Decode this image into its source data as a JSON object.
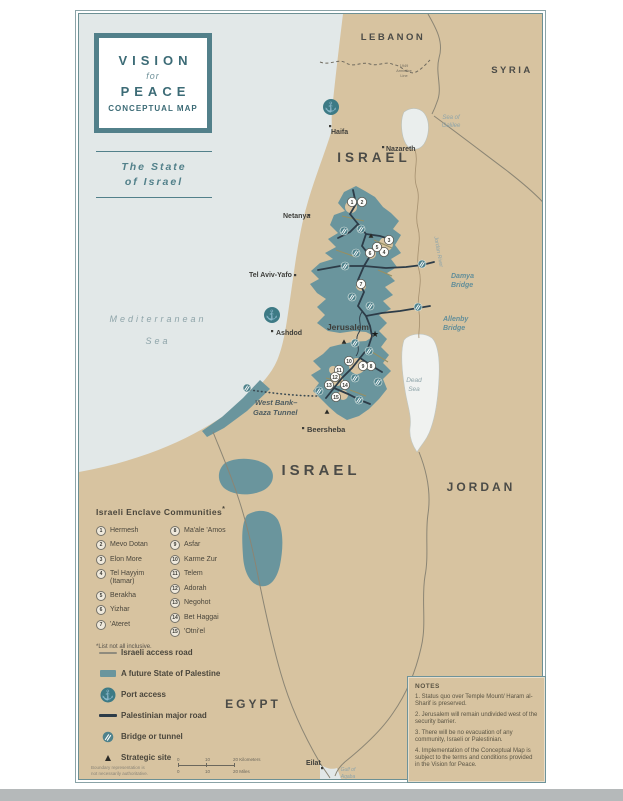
{
  "title_card": {
    "line1": "VISION",
    "line2": "for",
    "line3": "PEACE",
    "line4": "CONCEPTUAL MAP"
  },
  "subtitle": {
    "line1": "The State",
    "line2": "of Israel"
  },
  "countries": {
    "lebanon": "LEBANON",
    "syria": "SYRIA",
    "israel_north": "ISRAEL",
    "israel_south": "ISRAEL",
    "jordan": "JORDAN",
    "egypt": "EGYPT"
  },
  "cities": {
    "haifa": "Haifa",
    "nazareth": "Nazareth",
    "netanya": "Netanya",
    "tel_aviv": "Tel Aviv-Yafo",
    "ashdod": "Ashdod",
    "jerusalem": "Jerusalem",
    "beersheba": "Beersheba",
    "eilat": "Eilat"
  },
  "water": {
    "mediterranean_1": "Mediterranean",
    "mediterranean_2": "Sea",
    "galilee_1": "Sea of",
    "galilee_2": "Galilee",
    "dead_sea_1": "Dead",
    "dead_sea_2": "Sea",
    "aqaba_1": "Gulf of",
    "aqaba_2": "Aqaba",
    "jordan_river": "Jordan River"
  },
  "bridge_labels": {
    "damya_1": "Damya",
    "damya_2": "Bridge",
    "allenby_1": "Allenby",
    "allenby_2": "Bridge"
  },
  "armistice": {
    "line1": "1949",
    "line2": "Armistice",
    "line3": "Line"
  },
  "tunnel_label": {
    "line1": "West Bank–",
    "line2": "Gaza Tunnel"
  },
  "enclaves": {
    "title": "Israeli Enclave Communities",
    "footnote_mark": "*",
    "footnote": "*List not all inclusive.",
    "items": [
      {
        "num": "1",
        "name": "Hermesh"
      },
      {
        "num": "2",
        "name": "Mevo Dotan"
      },
      {
        "num": "3",
        "name": "Elon More"
      },
      {
        "num": "4",
        "name": "Tel Hayyim (Itamar)"
      },
      {
        "num": "5",
        "name": "Berakha"
      },
      {
        "num": "6",
        "name": "Yizhar"
      },
      {
        "num": "7",
        "name": "'Ateret"
      },
      {
        "num": "8",
        "name": "Ma'ale 'Amos"
      },
      {
        "num": "9",
        "name": "Asfar"
      },
      {
        "num": "10",
        "name": "Karme Zur"
      },
      {
        "num": "11",
        "name": "Telem"
      },
      {
        "num": "12",
        "name": "Adorah"
      },
      {
        "num": "13",
        "name": "Negohot"
      },
      {
        "num": "14",
        "name": "Bet Haggai"
      },
      {
        "num": "15",
        "name": "'Otni'el"
      }
    ]
  },
  "legend": {
    "items": [
      {
        "icon": "israeli-access-road",
        "label": "Israeli access road"
      },
      {
        "icon": "palestine-area",
        "label": "A future State of Palestine"
      },
      {
        "icon": "port",
        "label": "Port access"
      },
      {
        "icon": "palestinian-road",
        "label": "Palestinian major road"
      },
      {
        "icon": "bridge",
        "label": "Bridge or tunnel"
      },
      {
        "icon": "strategic",
        "label": "Strategic site"
      }
    ]
  },
  "notes": {
    "title": "NOTES",
    "items": [
      "1. Status quo over Temple Mount/ Haram al-Sharif is preserved.",
      "2. Jerusalem will remain undivided west of the security barrier.",
      "3. There will be no evacuation of any community, Israeli or Palestinian.",
      "4. Implementation of the Conceptual Map is subject to the terms and conditions provided in the Vision for Peace."
    ]
  },
  "scale": {
    "km": [
      "0",
      "10",
      "20 Kilometers"
    ],
    "mi": [
      "0",
      "10",
      "20 Miles"
    ]
  },
  "disclaimer": {
    "line1": "Boundary representation is",
    "line2": "not necessarily authoritative."
  },
  "colors": {
    "palestine_teal": "#6a959d",
    "land_tan": "#d7c3a0",
    "sea": "#e2e8e8",
    "frame_teal": "#52808a",
    "road_dark": "#2d3c48",
    "port_teal": "#3d7a85"
  }
}
